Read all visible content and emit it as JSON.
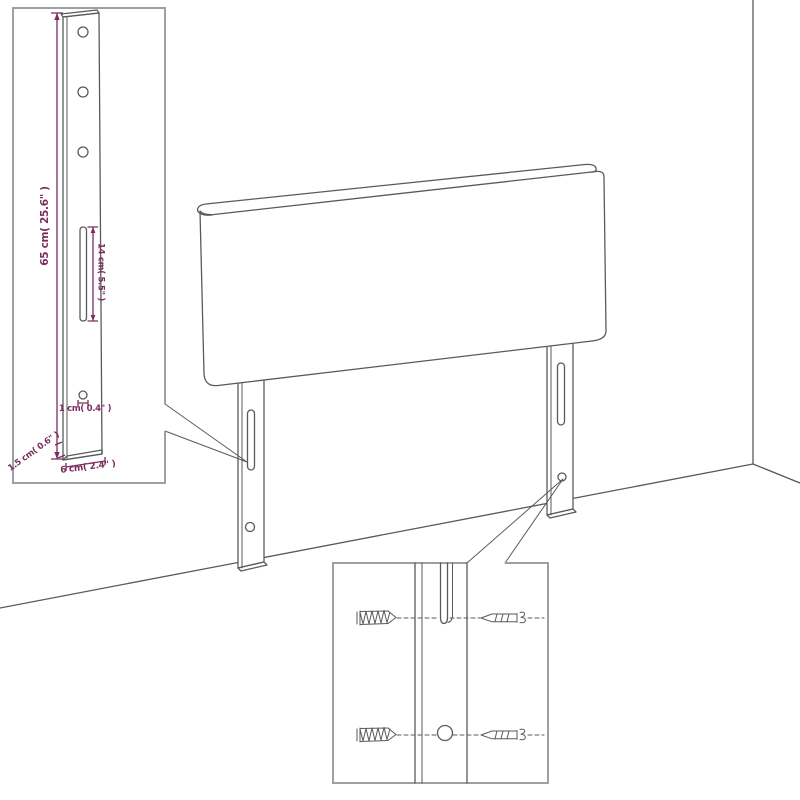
{
  "labels": {
    "height": "65 cm( 25.6\" )",
    "slot_height": "14 cm( 5.5\" )",
    "hole_diameter": "1 cm( 0.4\" )",
    "edge_thickness": "1.5 cm( 0.6\" )",
    "leg_width": "6 cm( 2.4\" )"
  },
  "colors": {
    "line": "#595a5c",
    "inset_border": "#9ba0a4",
    "dimension": "#7a2d5f",
    "background": "#ffffff"
  }
}
